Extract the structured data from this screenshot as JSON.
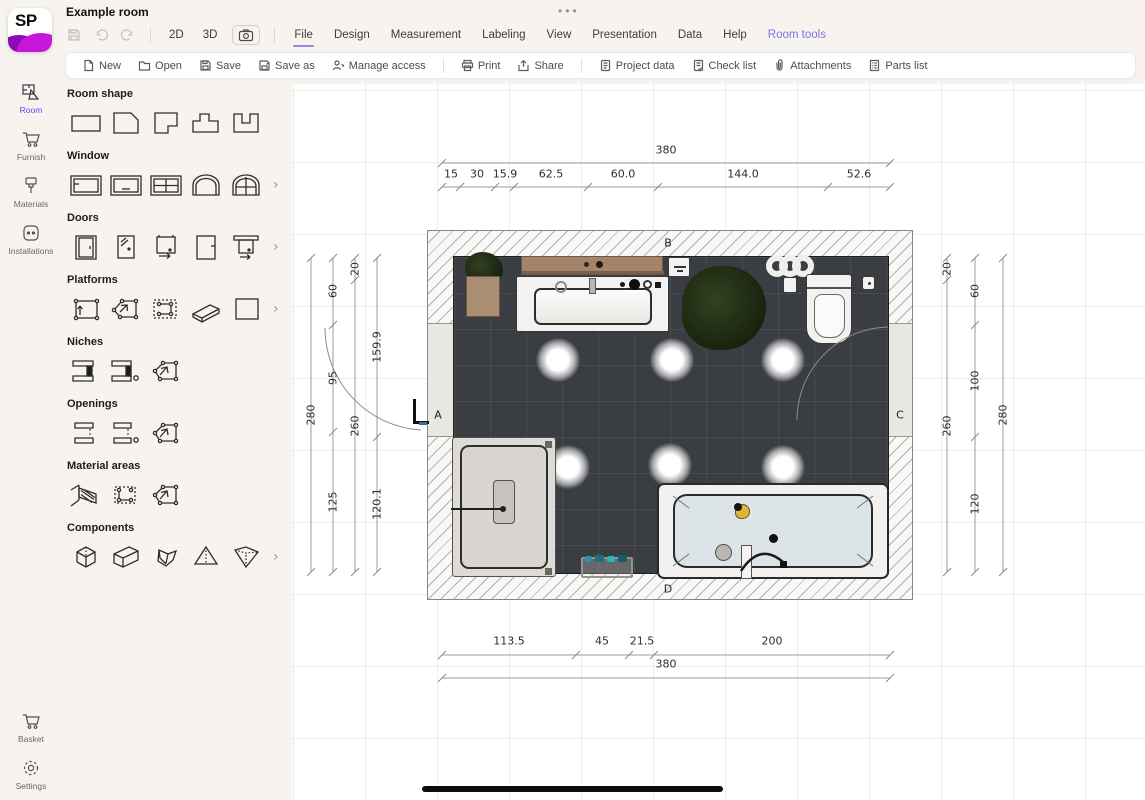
{
  "window": {
    "dots": "•••"
  },
  "header": {
    "title": "Example room",
    "logo_text": "SP"
  },
  "topbar": {
    "view_2d": "2D",
    "view_3d": "3D",
    "menus": [
      "File",
      "Design",
      "Measurement",
      "Labeling",
      "View",
      "Presentation",
      "Data",
      "Help",
      "Room tools"
    ],
    "active_menu": "File",
    "highlighted_menu": "Room tools"
  },
  "filebar": {
    "labels": [
      "New",
      "Open",
      "Save",
      "Save as",
      "Manage access",
      "Print",
      "Share",
      "Project data",
      "Check list",
      "Attachments",
      "Parts list"
    ]
  },
  "nav": {
    "items": [
      {
        "label": "Room",
        "active": true
      },
      {
        "label": "Furnish",
        "active": false
      },
      {
        "label": "Materials",
        "active": false
      },
      {
        "label": "Installations",
        "active": false
      }
    ],
    "bottom": [
      {
        "label": "Basket"
      },
      {
        "label": "Settings"
      }
    ]
  },
  "panel": {
    "sections": [
      {
        "title": "Room shape",
        "more": false,
        "icons": [
          "rectangle",
          "cut-corner",
          "l-shape",
          "t-shape",
          "u-shape"
        ]
      },
      {
        "title": "Window",
        "more": true,
        "icons": [
          "window-basic",
          "window-inner",
          "window-cross",
          "window-arch",
          "window-arch-cross"
        ]
      },
      {
        "title": "Doors",
        "more": true,
        "icons": [
          "door-frame",
          "door-glass",
          "door-sliding",
          "door-plain",
          "door-rail"
        ]
      },
      {
        "title": "Platforms",
        "more": true,
        "icons": [
          "platform-rect",
          "platform-poly",
          "platform-dashed",
          "platform-slab",
          "platform-square"
        ]
      },
      {
        "title": "Niches",
        "more": false,
        "icons": [
          "niche-wall",
          "niche-wall-point",
          "niche-poly"
        ]
      },
      {
        "title": "Openings",
        "more": false,
        "icons": [
          "opening-wall",
          "opening-wall-point",
          "opening-poly"
        ]
      },
      {
        "title": "Material areas",
        "more": false,
        "icons": [
          "material-wall",
          "material-rect",
          "material-poly"
        ]
      },
      {
        "title": "Components",
        "more": true,
        "icons": [
          "cube",
          "box",
          "wedge",
          "pyramid",
          "inverted-pyramid"
        ]
      }
    ]
  },
  "plan": {
    "walls": {
      "left": "A",
      "top": "B",
      "right": "C",
      "bottom": "D"
    },
    "dims": {
      "top_total": "380",
      "top_segments": [
        "15",
        "30",
        "15.9",
        "62.5",
        "60.0",
        "144.0",
        "52.6"
      ],
      "bottom_segments": [
        "113.5",
        "45",
        "21.5",
        "200"
      ],
      "bottom_total": "380",
      "left_total": "280",
      "left_col2": [
        "60",
        "95",
        "125"
      ],
      "left_col3": [
        "20",
        "260"
      ],
      "left_col4": [
        "159.9",
        "120.1"
      ],
      "right_col1": [
        "20",
        "260"
      ],
      "right_col2": [
        "60",
        "100",
        "120"
      ],
      "right_total": "280"
    }
  },
  "colors": {
    "accent": "#7b72e6",
    "active_purple": "#6d3ff0",
    "magenta": "#c716da",
    "floor": "#3a3d41"
  }
}
